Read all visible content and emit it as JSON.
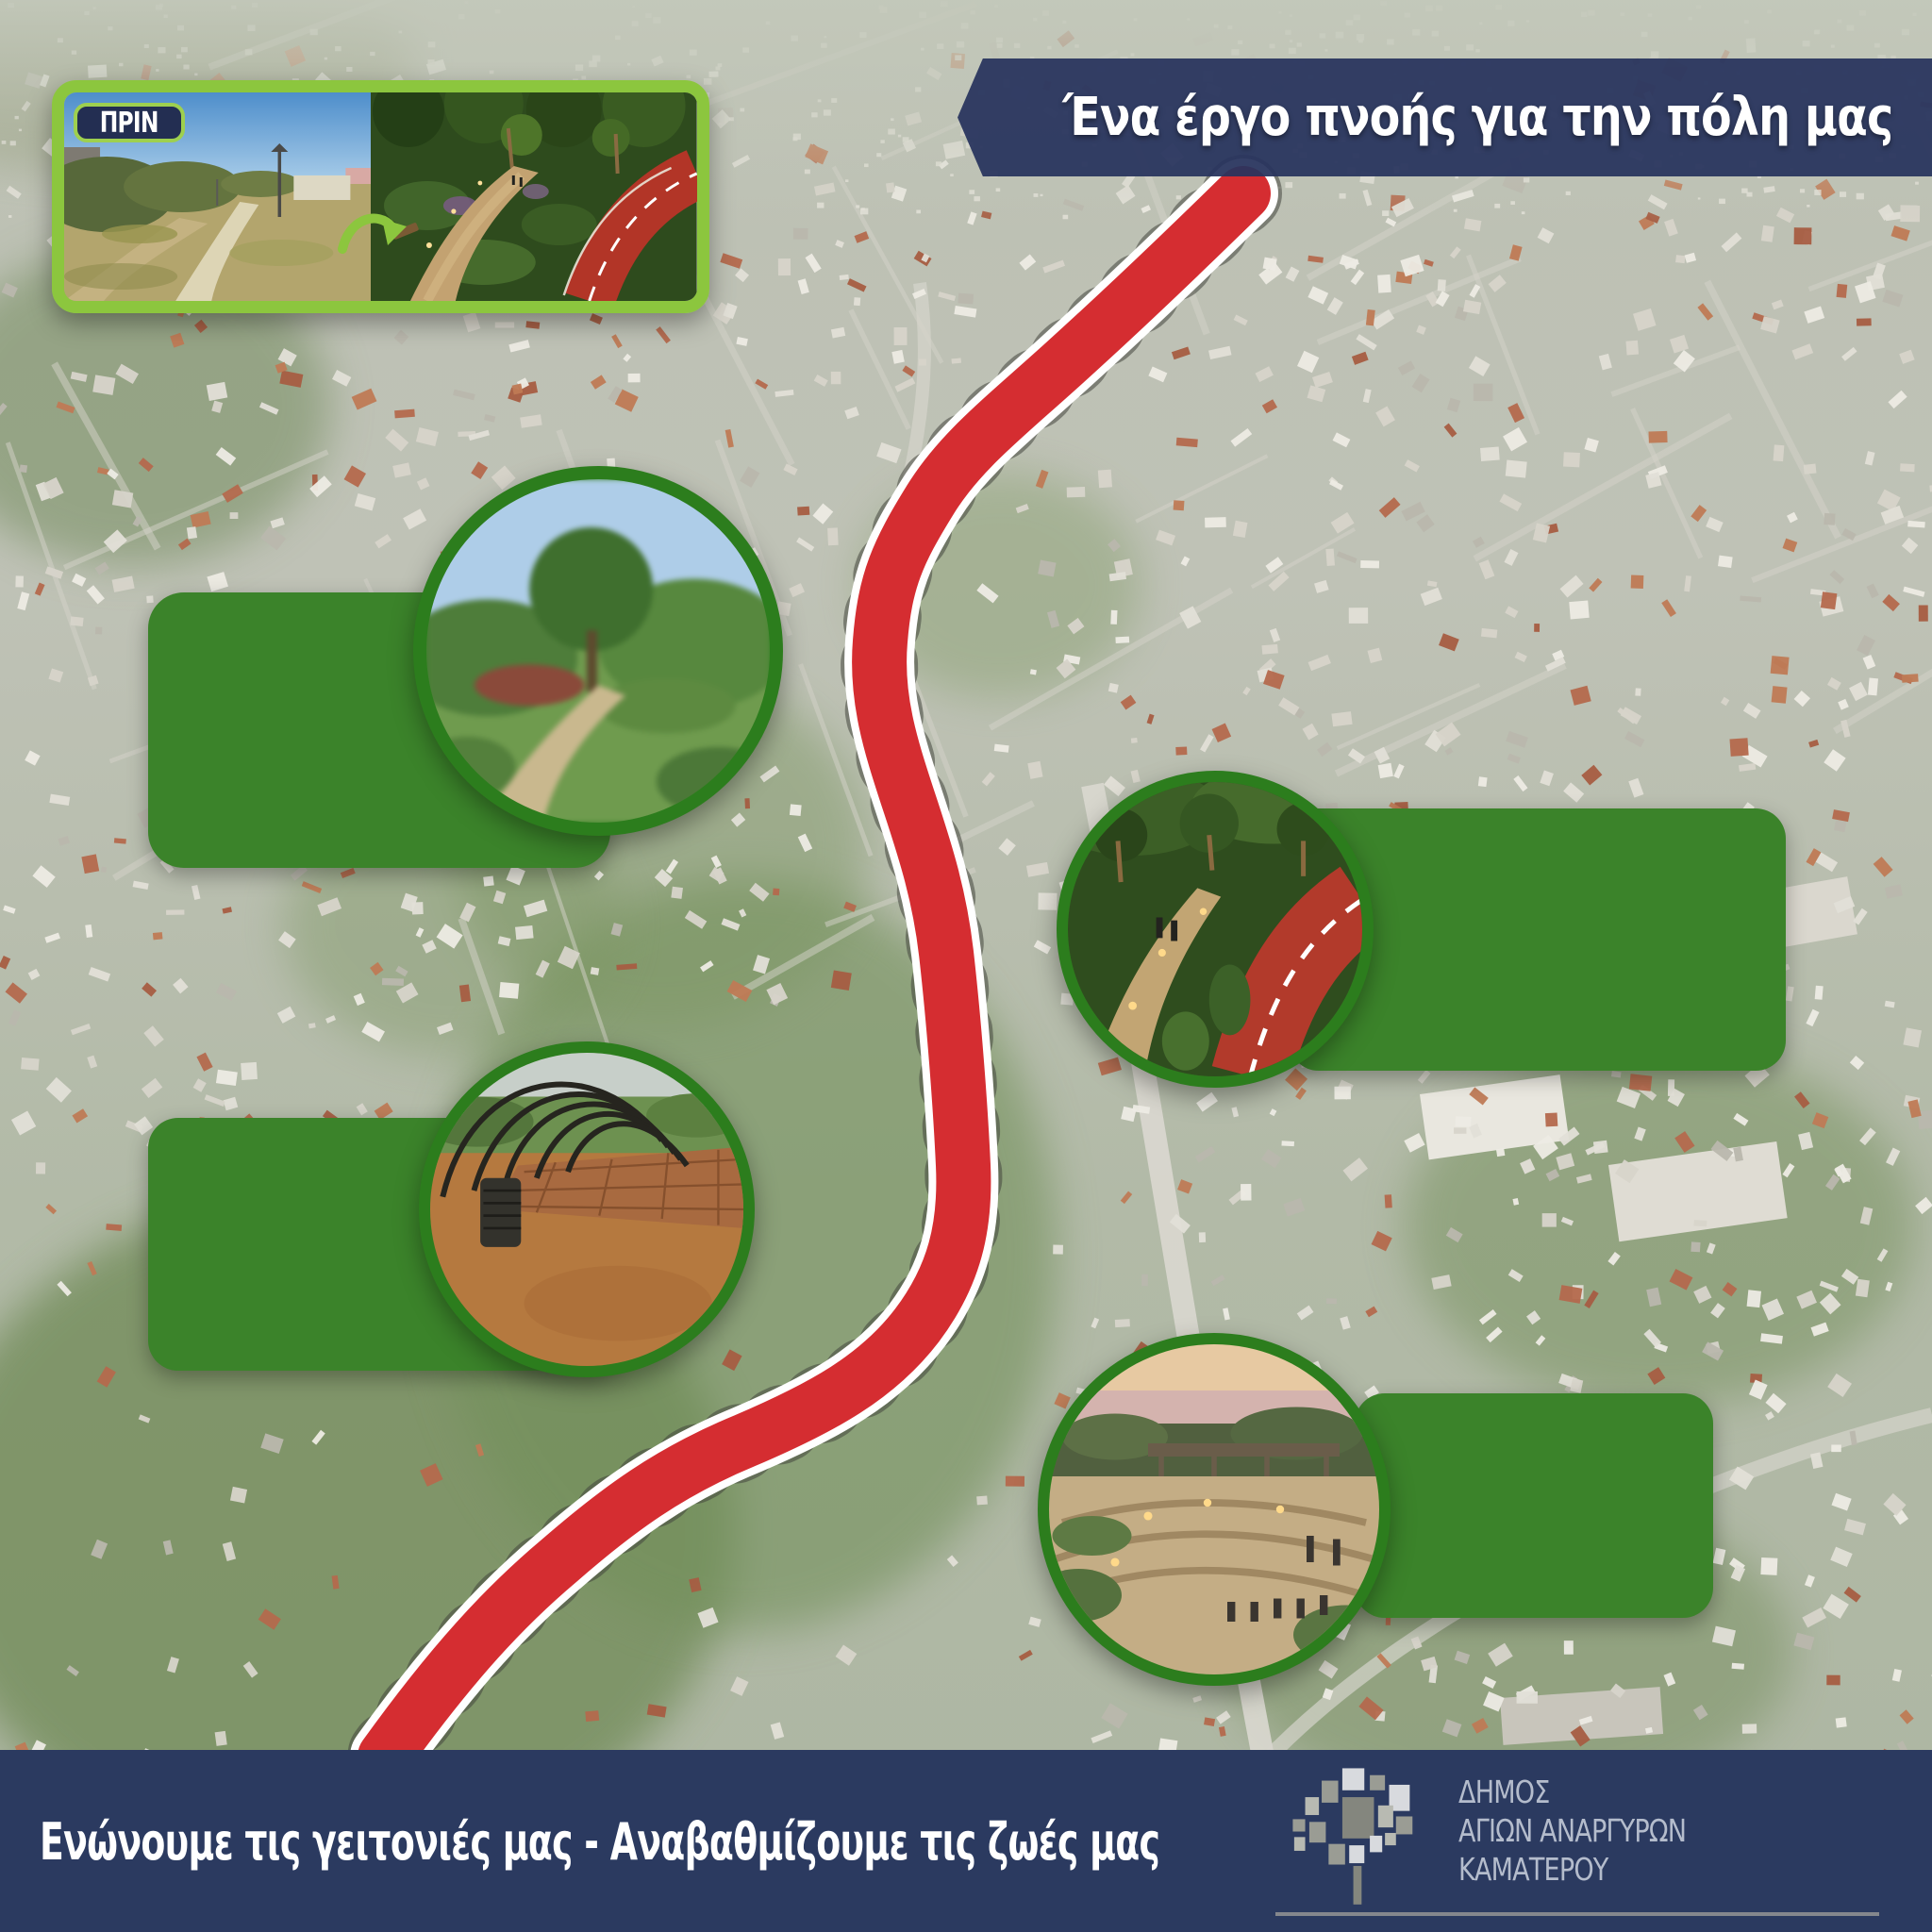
{
  "title": "Municipal greenway project poster",
  "accent_colors": {
    "frame_green": "#8cc63e",
    "box_green": "#3b832a",
    "ring_green": "#2c7d1d",
    "navy": "#2b3a60",
    "route_red": "#d52d31"
  },
  "header": {
    "banner_text": "Ένα έργο πνοής για την πόλη μας",
    "before_label": "ΠΡΙΝ",
    "after_label": "ΜΕΤΑ",
    "arrow_icon": "curved-arrow-icon"
  },
  "callouts": [
    {
      "label": "Αποκατάσταση Φυσικού τοπίου",
      "lines": [
        "Αποκατάσταση",
        "Φυσικού τοπίου"
      ],
      "image": "park-path-render"
    },
    {
      "label": "Μεικτές διαδρομές περιπάτου & ποδηλάτου",
      "lines": [
        "Μεικτές διαδρομές",
        "περιπάτου &",
        "ποδηλάτου"
      ],
      "image": "mixed-walk-bike-path-render"
    },
    {
      "label": "Ασφαλείς ζώνες κυκλοφορίας & πεζόδρομοι",
      "lines": [
        "Ασφαλείς ζώνες",
        "κυκλοφορίας &",
        "πεζόδρομοι"
      ],
      "image": "pergola-walkway-photo"
    },
    {
      "label": "Χώροι εκδηλώσεων",
      "lines": [
        "Χώροι",
        "εκδηλώσεων"
      ],
      "image": "event-amphitheater-render"
    }
  ],
  "map": {
    "type": "aerial-city-photo",
    "route_marker": "red-greenway-route"
  },
  "footer": {
    "tagline": "Ενώνουμε τις γειτονιές μας - Αναβαθμίζουμε τις ζωές μας",
    "logo_icon": "municipality-tree-logo",
    "municipality": {
      "line1": "ΔΗΜΟΣ",
      "line2": "ΑΓΙΩΝ ΑΝΑΡΓΥΡΩΝ",
      "line3": "ΚΑΜΑΤΕΡΟΥ"
    }
  }
}
